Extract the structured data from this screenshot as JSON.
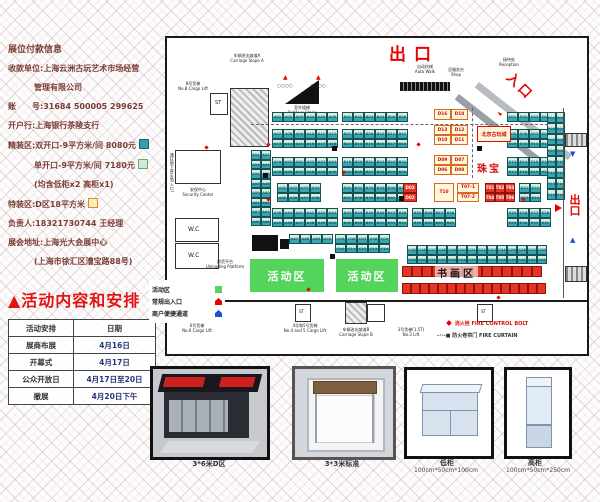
{
  "left_panel": {
    "lines": [
      "展位付款信息",
      "收款单位:上海云洲古玩艺术市场经营",
      "管理有限公司",
      "账　　号:31684 500005 299625",
      "开户行:上海银行茶陵支行",
      "精装区:双开口-9平方米/间 8080元",
      "单开口-9平方米/间 7180元",
      "(均含低柜x2 高柜x1)",
      "特装区:D区18平方米",
      "负责人:18321730744 王经理",
      "展会地址:上海光大会展中心",
      "(上海市徐汇区漕宝路88号)"
    ],
    "schedule": {
      "title": "▲活动内容和安排",
      "header": [
        "活动安排",
        "日期"
      ],
      "rows": [
        [
          "展商布展",
          "4月16日"
        ],
        [
          "开幕式",
          "4月17日"
        ],
        [
          "公众开放日",
          "4月17日至20日"
        ],
        [
          "撤展",
          "4月20日下午"
        ]
      ]
    }
  },
  "plan": {
    "labels": {
      "exit_top": "出口",
      "entrance": "入口",
      "exit_right": "出口",
      "slope_a_cn": "车辆进出坡道A",
      "slope_a_en": "Carriage Slope A",
      "outdoor_cn": "室外楼梯",
      "outdoor_en": "Outdoor Stairs",
      "autowalk_cn": "自动扶梯",
      "autowalk_en": "Auto Walk",
      "reception_cn": "接待处",
      "reception_en": "Reception",
      "shop_cn": "总服务台",
      "shop_en": "Shop",
      "cargo8_cn": "8号货梯",
      "cargo8_en": "No.8 Cargo Lift",
      "underground": "通往地下停车场(入口)",
      "security_cn": "安保中心",
      "security_en": "Security Center",
      "wc": "W.C",
      "st": "ST",
      "unloading_cn": "卸货平台",
      "unloading_en": "Unloading Platform",
      "cargo6_cn": "6号货梯",
      "cargo6_en": "No.6 Cargo Lift",
      "cargo45_cn": "4号和5号货梯",
      "cargo45_en": "No.4 and 5 Cargo Lift",
      "slope_b_cn": "车辆进出坡道B",
      "slope_b_en": "Carriage Slope B",
      "lift3_cn": "3号货梯(1.5T)",
      "lift3_en": "No.3 Lift",
      "beijing": "北京古玩城",
      "jewelry": "珠宝",
      "calligraphy": "书画区",
      "activity": "活动区",
      "legend_activity": "活动区",
      "legend_entrance": "常规出入口",
      "legend_merchant": "商户便捷通道",
      "fire_bolt": "消火栓  FIRE CONTROL BOLT",
      "fire_curtain": "防火卷帘门  FIRE CURTAIN"
    },
    "colors": {
      "booth_teal": "#37a5b2",
      "booth_green": "#d9eedd",
      "booth_cream": "#fdf6d8",
      "booth_red": "#e63327",
      "activity_green": "#55d45c",
      "accent_red": "#e60000"
    },
    "booth_blocks": [
      {
        "x": 105,
        "y": 74,
        "cols": 6,
        "rows": 1,
        "type": "teal",
        "seq": [
          "A",
          1,
          6
        ]
      },
      {
        "x": 175,
        "y": 74,
        "cols": 6,
        "rows": 1,
        "type": "teal",
        "seq": [
          "B",
          1,
          6
        ]
      },
      {
        "x": 340,
        "y": 74,
        "cols": 4,
        "rows": 1,
        "type": "teal",
        "seq": [
          "E",
          1,
          4
        ]
      },
      {
        "x": 267,
        "y": 71,
        "cols": 2,
        "rows": 1,
        "cw": 17,
        "ch": 11,
        "type": "cream",
        "list": [
          "D16",
          "D18"
        ]
      },
      {
        "x": 105,
        "y": 91,
        "cols": 6,
        "rows": 2,
        "type": "teal",
        "seq": [
          "A",
          7,
          18
        ]
      },
      {
        "x": 175,
        "y": 91,
        "cols": 6,
        "rows": 2,
        "type": "teal",
        "seq": [
          "B",
          7,
          18
        ]
      },
      {
        "x": 340,
        "y": 91,
        "cols": 4,
        "rows": 2,
        "type": "teal",
        "seq": [
          "E",
          5,
          12
        ]
      },
      {
        "x": 267,
        "y": 87,
        "cols": 2,
        "rows": 2,
        "cw": 17,
        "ch": 10,
        "type": "cream",
        "list": [
          "D13",
          "D12",
          "D10",
          "D11"
        ]
      },
      {
        "x": 105,
        "y": 119,
        "cols": 6,
        "rows": 2,
        "type": "teal",
        "seq": [
          "A",
          19,
          30
        ]
      },
      {
        "x": 175,
        "y": 119,
        "cols": 6,
        "rows": 2,
        "type": "teal",
        "seq": [
          "B",
          19,
          30
        ]
      },
      {
        "x": 340,
        "y": 119,
        "cols": 4,
        "rows": 2,
        "type": "teal",
        "seq": [
          "E",
          13,
          20
        ]
      },
      {
        "x": 267,
        "y": 117,
        "cols": 2,
        "rows": 2,
        "cw": 17,
        "ch": 10,
        "type": "cream",
        "list": [
          "D09",
          "D07",
          "D06",
          "D08"
        ]
      },
      {
        "x": 110,
        "y": 145,
        "cols": 4,
        "rows": 2,
        "type": "teal",
        "seq": [
          "A",
          31,
          38
        ]
      },
      {
        "x": 175,
        "y": 145,
        "cols": 6,
        "rows": 2,
        "type": "teal",
        "seq": [
          "B",
          31,
          42
        ]
      },
      {
        "x": 236,
        "y": 145,
        "cols": 1,
        "rows": 2,
        "cw": 14,
        "type": "red",
        "list": [
          "D03",
          "D02"
        ]
      },
      {
        "x": 267,
        "y": 145,
        "cols": 1,
        "rows": 1,
        "cw": 20,
        "ch": 19,
        "type": "cream",
        "list": [
          "T10"
        ]
      },
      {
        "x": 290,
        "y": 145,
        "cols": 1,
        "rows": 2,
        "cw": 22,
        "type": "cream",
        "list": [
          "T07-1",
          "T07-2"
        ]
      },
      {
        "x": 318,
        "y": 145,
        "cols": 3,
        "rows": 2,
        "cw": 10,
        "type": "red",
        "seq": [
          "T",
          1,
          6
        ]
      },
      {
        "x": 352,
        "y": 145,
        "cols": 2,
        "rows": 2,
        "type": "teal",
        "seq": [
          "E",
          21,
          24
        ]
      },
      {
        "x": 105,
        "y": 170,
        "cols": 6,
        "rows": 2,
        "type": "teal",
        "seq": [
          "A",
          39,
          50
        ]
      },
      {
        "x": 175,
        "y": 170,
        "cols": 6,
        "rows": 2,
        "type": "teal",
        "seq": [
          "B",
          43,
          54
        ]
      },
      {
        "x": 245,
        "y": 170,
        "cols": 4,
        "rows": 2,
        "type": "teal",
        "seq": [
          "B",
          55,
          62
        ]
      },
      {
        "x": 340,
        "y": 170,
        "cols": 4,
        "rows": 2,
        "type": "teal",
        "seq": [
          "E",
          25,
          32
        ]
      },
      {
        "x": 84,
        "y": 112,
        "cols": 2,
        "rows": 8,
        "cw": 10,
        "type": "teal",
        "seq": [
          "A",
          51,
          66
        ]
      },
      {
        "x": 380,
        "y": 74,
        "cols": 2,
        "rows": 8,
        "cw": 9,
        "ch": 11,
        "type": "teal",
        "seq": [
          "F",
          1,
          16
        ]
      },
      {
        "x": 122,
        "y": 196,
        "cols": 4,
        "rows": 1,
        "type": "teal",
        "list": [
          "A67",
          "A68",
          "A69",
          "A70"
        ]
      },
      {
        "x": 168,
        "y": 196,
        "cols": 5,
        "rows": 2,
        "type": "teal",
        "seq": [
          "C",
          5,
          14
        ]
      },
      {
        "x": 240,
        "y": 207,
        "cols": 14,
        "rows": 2,
        "cw": 10,
        "type": "teal",
        "seq": [
          "C",
          15,
          42
        ]
      },
      {
        "x": 235,
        "y": 228,
        "cols": 14,
        "rows": 1,
        "cw": 10,
        "ch": 11,
        "type": "red"
      },
      {
        "x": 235,
        "y": 245,
        "cols": 16,
        "rows": 1,
        "cw": 9,
        "ch": 11,
        "type": "red"
      }
    ]
  },
  "photos": [
    {
      "caption": "3*6米D区",
      "size": ""
    },
    {
      "caption": "3*3米标准",
      "size": ""
    },
    {
      "caption": "低柜",
      "size": "100cm*50cm*100cm"
    },
    {
      "caption": "高柜",
      "size": "100cm*50cm*250cm"
    }
  ]
}
